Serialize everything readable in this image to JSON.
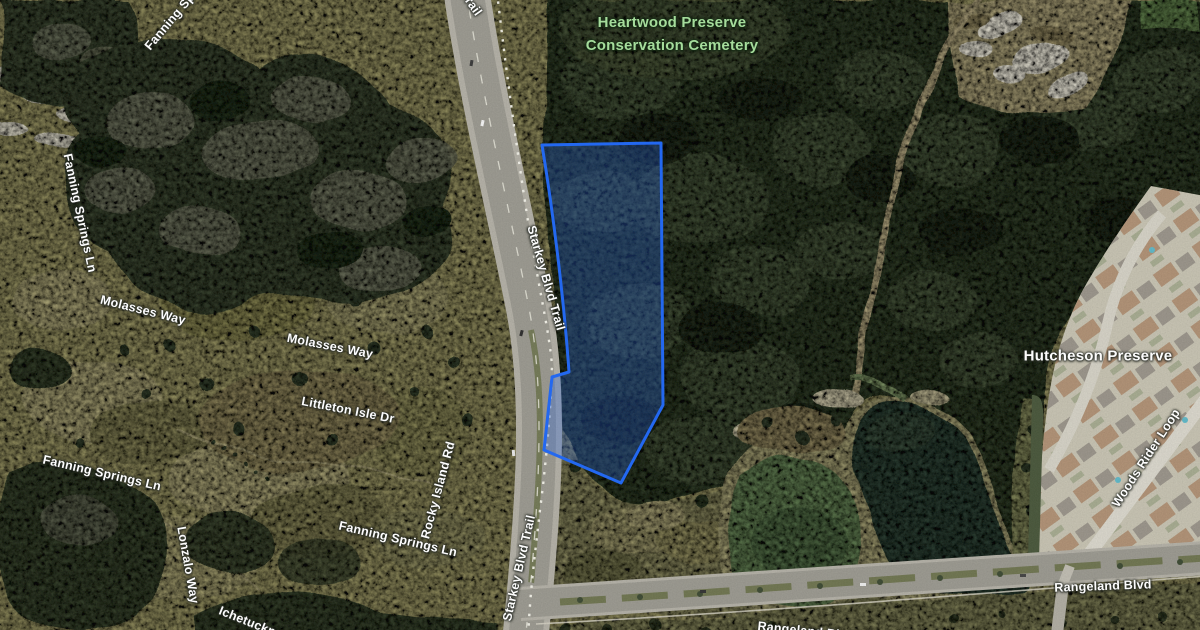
{
  "map": {
    "kind": "satellite-map",
    "colors": {
      "parcel_outline": "#2368f0",
      "poi_green": "#a5dc9b",
      "street_label": "#fdfdfd"
    },
    "poi": {
      "heartwood_line1": "Heartwood Preserve",
      "heartwood_line2": "Conservation Cemetery",
      "hutcheson": "Hutcheson Preserve"
    },
    "streets": {
      "fanning_top": "Fanning Springs Ln",
      "fanning_left": "Fanning Springs Ln",
      "molasses_1": "Molasses Way",
      "molasses_2": "Molasses Way",
      "littleton": "Littleton Isle Dr",
      "fanning_mid": "Fanning Springs Ln",
      "fanning_bot": "Fanning Springs Ln",
      "lonzalo": "Lonzalo Way",
      "ichetucknee": "Ichetucknee",
      "rocky": "Rocky Island Rd",
      "starkey_top": "Starkey Blvd Trail",
      "starkey_1": "Starkey Blvd Trail",
      "starkey_2": "Starkey Blvd Trail",
      "rangeland_1": "Rangeland Blvd",
      "rangeland_2": "Rangeland Blvd",
      "woods_rider": "Woods Rider Loop"
    }
  }
}
